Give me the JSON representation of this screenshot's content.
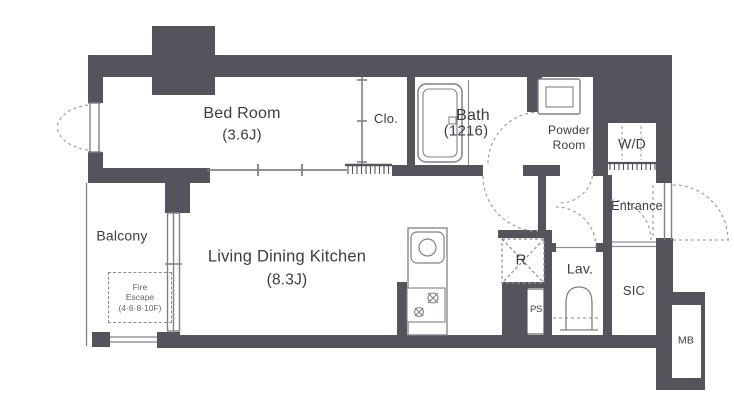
{
  "plan": {
    "title": "apartment-floor-plan",
    "colors": {
      "wall": "#54555c",
      "line": "#7d8288",
      "dashed": "#9aa0a6",
      "text": "#3a3d44"
    },
    "rooms": {
      "bedroom": {
        "name": "Bed Room",
        "size": "(3.6J)"
      },
      "closet": {
        "label": "Clo."
      },
      "bath": {
        "name": "Bath",
        "size": "(1216)"
      },
      "powder": {
        "line1": "Powder",
        "line2": "Room"
      },
      "wd": {
        "label": "W/D"
      },
      "entrance": {
        "label": "Entrance"
      },
      "balcony": {
        "label": "Balcony"
      },
      "fire_escape": {
        "line1": "Fire",
        "line2": "Escape",
        "line3": "(4·6·8·10F)"
      },
      "ldk": {
        "name": "Living Dining Kitchen",
        "size": "(8.3J)"
      },
      "fridge": {
        "label": "R"
      },
      "ps": {
        "label": "PS"
      },
      "lavatory": {
        "label": "Lav."
      },
      "sic": {
        "label": "SIC"
      },
      "mb": {
        "label": "MB"
      }
    }
  }
}
